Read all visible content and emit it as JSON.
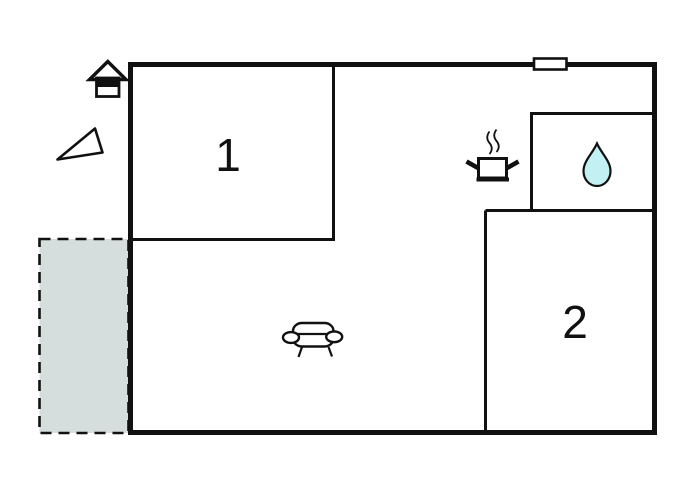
{
  "plan": {
    "type": "floor-plan",
    "room_labels": {
      "room1": "1",
      "room2": "2"
    },
    "icons": {
      "house": "house-icon",
      "north_arrow": "north-arrow-icon",
      "window": "window-marker",
      "kitchen_pot": "kitchen-pot-icon",
      "water_drop": "water-drop-icon",
      "sofa": "sofa-icon"
    },
    "areas": {
      "terrace": "dashed-outdoor-area",
      "bathroom": "room-with-water-drop",
      "kitchen_zone": "area-with-cooking-pot",
      "living_zone": "area-with-sofa"
    }
  },
  "colors": {
    "wall": "#111111",
    "terrace_fill": "#d5dddd",
    "water_drop_fill": "#c3f0f2",
    "background": "#ffffff"
  }
}
